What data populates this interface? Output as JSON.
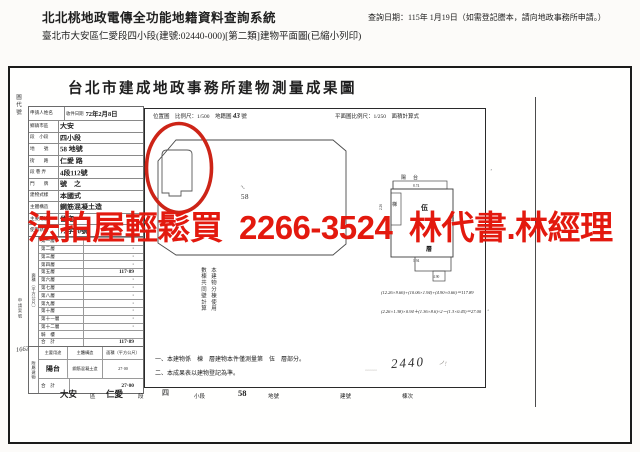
{
  "colors": {
    "ad_red": "#e3190e",
    "circle_red": "#cd2417",
    "ink": "#1f1f1f"
  },
  "header": {
    "system_title": "北北桃地政電傳全功能地籍資料查詢系統",
    "query_date": "查詢日期：115年 1月19日（如需登記謄本，請向地政事務所申請。）",
    "doc_line": "臺北市大安區仁愛段四小段(建號:02440-000)[第二類]建物平面圖(已縮小列印)"
  },
  "overlay": {
    "ad_text": "法拍屋輕鬆買 2266-3524 林代書.林經理"
  },
  "form": {
    "title": "台北市建成地政事務所建物測量成果圖",
    "side_label": "圖代號",
    "applicant_label": "申請人姓名",
    "receive": {
      "label": "收件日期",
      "value": "72年2月8日"
    },
    "location_rows": [
      {
        "label": "鄉鎮市區",
        "value": "大安"
      },
      {
        "label": "段　小段",
        "value": "四小段"
      },
      {
        "label": "地　　號",
        "value": "58 地號"
      },
      {
        "label": "街　　路",
        "value": "仁愛 路"
      },
      {
        "label": "段 巷 弄",
        "value": "4段112號"
      },
      {
        "label": "門　　牌",
        "value": "號　之"
      },
      {
        "label": "建物式樣",
        "value": "本國式"
      },
      {
        "label": "主體構造",
        "value": "鋼筋混凝土造"
      },
      {
        "label": "主要用途",
        "value": "住宅"
      },
      {
        "label": "使用執照",
        "value": "72字10號"
      }
    ],
    "area": {
      "side_label": "面積（平方公尺）",
      "case_label": "申請案號",
      "case_no": "1662",
      "floors": [
        {
          "label": "第一層",
          "value": "·"
        },
        {
          "label": "第二層",
          "value": "·"
        },
        {
          "label": "第三層",
          "value": "·"
        },
        {
          "label": "第四層",
          "value": "·"
        },
        {
          "label": "第五層",
          "value": "117·89"
        },
        {
          "label": "第六層",
          "value": "·"
        },
        {
          "label": "第七層",
          "value": "·"
        },
        {
          "label": "第八層",
          "value": "·"
        },
        {
          "label": "第九層",
          "value": "·"
        },
        {
          "label": "第十層",
          "value": "·"
        },
        {
          "label": "第十一層",
          "value": "·"
        },
        {
          "label": "第十二層",
          "value": "·"
        },
        {
          "label": "騎　樓",
          "value": ""
        },
        {
          "label": "合　計",
          "value": "117·89"
        }
      ]
    },
    "attachments": {
      "side_label": "附屬建物",
      "headers": [
        "主要用途",
        "主體構造",
        "面積（平方公尺）"
      ],
      "use": "陽台",
      "structure": "鋼筋混凝土造",
      "area_value": "27·00",
      "total_label": "合　計",
      "total_value": "27·00"
    },
    "bottom_strip": {
      "v1": "大安",
      "l1": "區",
      "v2": "仁愛",
      "l2": "段",
      "v3": "四",
      "l3": "小段",
      "v4": "58",
      "l4": "地號",
      "l5": "建號",
      "l6": "棟次"
    }
  },
  "plan": {
    "header_left": "位置圖　比例尺：1/500　地籍圖",
    "header_left_no": "43",
    "header_left_suffix": "號",
    "header_right": "平面圖比例尺：1/250　面積計算式",
    "parcel_no": "58",
    "parcel_tick": "〜",
    "labels": {
      "balcony": "陽台",
      "stair": "梯",
      "unit": "伍",
      "floor": "層"
    },
    "dims": {
      "d1": "8.74",
      "d2": "2.26",
      "d3": "10.06",
      "d4": "1.94",
      "d5": "4.90"
    },
    "calc1": "(12.26×9.66)+(10.06×1.94)+(4.90×0.66)＝117.89",
    "calc2": "(2.26×1.38)×0.94＋(1.36×8.6)÷2－(1.3×0.45)＝27.00",
    "vnote1": "本建物分棟使用",
    "vnote2": "數棟共同壁計算",
    "note1": "一、本建物係　棟　層建物本件僅測量第　伍　層部分。",
    "note2": "二、本成果表以建物登記為準。",
    "hand_no": "2440",
    "scribble1": "﹏﹏",
    "scribble2": "ノ!"
  }
}
